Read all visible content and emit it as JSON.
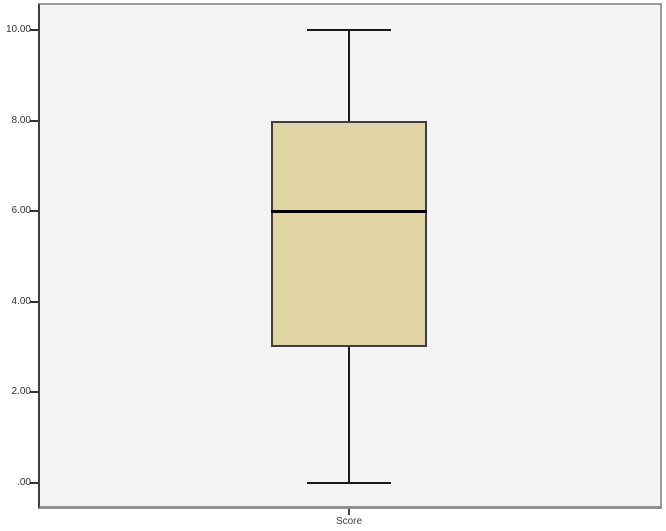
{
  "chart_data": {
    "type": "boxplot",
    "title": "",
    "xlabel": "Score",
    "ylabel": "",
    "categories": [
      "Score"
    ],
    "series": [
      {
        "name": "Score",
        "min": 0,
        "q1": 3,
        "median": 6,
        "q3": 8,
        "max": 10,
        "outliers": []
      }
    ],
    "ylim": [
      0,
      10
    ],
    "yticks": [
      {
        "value": 0,
        "label": ".00"
      },
      {
        "value": 2,
        "label": "2.00"
      },
      {
        "value": 4,
        "label": "4.00"
      },
      {
        "value": 6,
        "label": "6.00"
      },
      {
        "value": 8,
        "label": "8.00"
      },
      {
        "value": 10,
        "label": "10.00"
      }
    ],
    "grid": false,
    "legend": "none",
    "colors": {
      "box_fill": "#e0d5a2",
      "box_border": "#3f3f3f",
      "median": "#000000",
      "whisker": "#1a1a1a",
      "plot_bg": "#f4f4f4",
      "frame_border": "#9a9a9a",
      "axis_line": "#333333",
      "axis_text": "#333333"
    }
  }
}
